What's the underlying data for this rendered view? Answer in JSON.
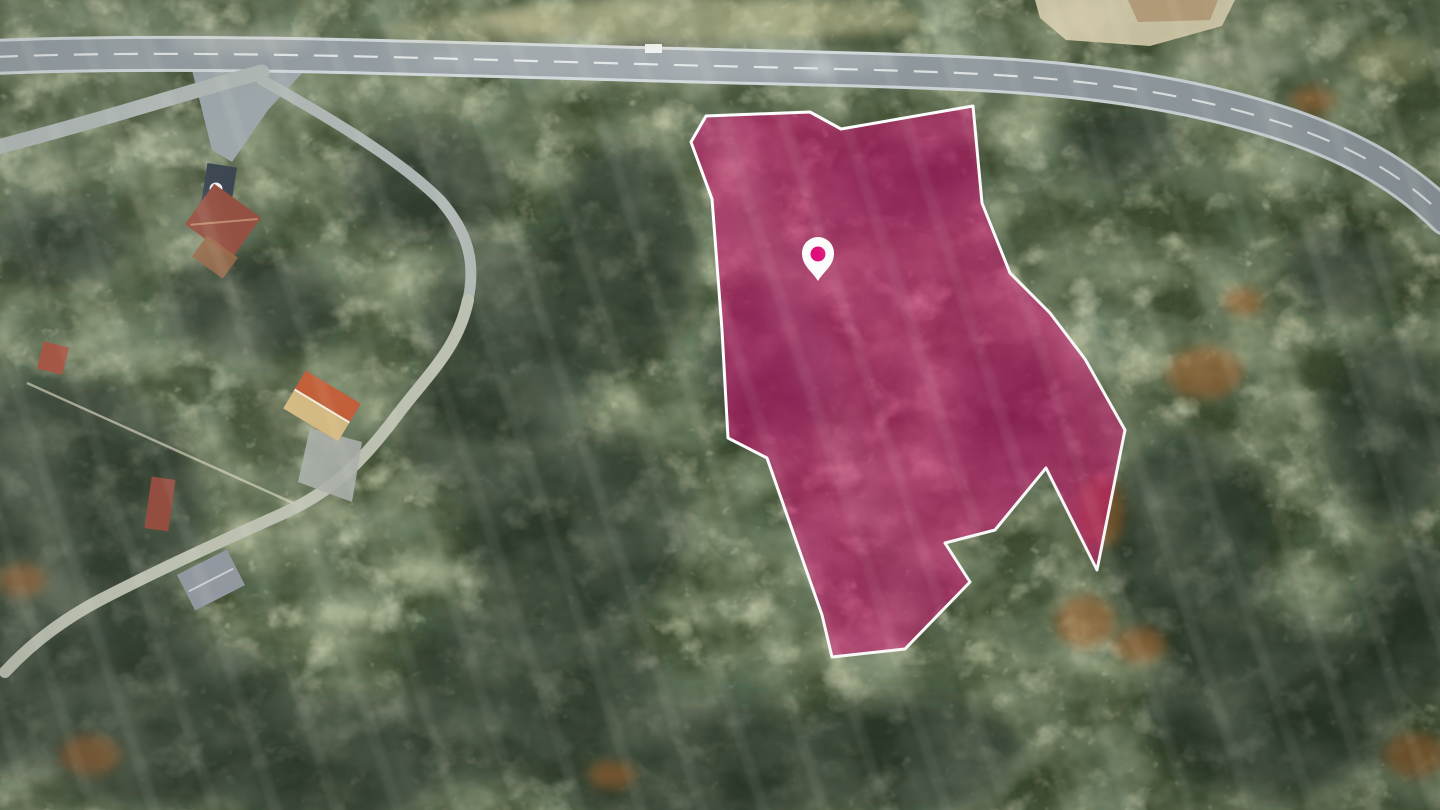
{
  "scene": {
    "title": "Aerial drone photograph of forested hillside with highlighted land parcel",
    "width": 1440,
    "height": 810
  },
  "palette": {
    "forest_base": "#3d4a2e",
    "forest_mid": "#68784c",
    "forest_light": "#b9bd84",
    "forest_pale": "#daddab",
    "shadow_color": "#15231c",
    "shadow_opacity": "0.52",
    "rust_color": "#a4612c",
    "rust_opacity": "0.55",
    "road_asphalt": "#8e989d",
    "road_casing": "#ccd3d6",
    "road_secondary": "#abb3b0",
    "road_dirt": "#b9beae",
    "lane_marking": "#f3f5f4",
    "junction_apron": "#98a2a6",
    "footpath": "#d8d4be",
    "sand": "#dbd2b0",
    "terrace": "#b69a74"
  },
  "parcel": {
    "points": "706,116 810,112 841,129 973,106 982,203 1010,273 1050,313 1085,359 1125,430 1097,570 1046,468 995,530 945,543 970,582 905,649 832,657 822,615 767,458 728,438 722,330 712,199 691,142",
    "fill": "#d80e74",
    "fill_opacity": "0.55",
    "stroke": "#ffffff",
    "stroke_width": "3"
  },
  "pin": {
    "d": "M 818 281 C 812 271 802 266 802 253 A 16 16 0 1 1 834 253 C 834 266 824 271 818 281 Z",
    "fill": "#ffffff",
    "dot_cx": "818",
    "dot_cy": "254",
    "dot_r": "7.5",
    "dot_fill": "#e00b78"
  },
  "roads": {
    "main_d": "M -6 57 C 180 49 420 58 640 64 C 780 68 880 69 980 74 C 1100 80 1200 96 1290 126 C 1360 150 1408 180 1446 218",
    "main_width": "30",
    "casing_width": "36",
    "dash_array": "24 16",
    "dash_width": "2.2",
    "dash_opacity": "0.8",
    "branch_left_d": "M 262 72 C 200 88 120 115 -6 148",
    "branch_left_width": "15",
    "east_d": "M 262 80 C 330 118 400 160 440 200 C 468 232 476 262 468 300",
    "east_width": "11",
    "west_d": "M 468 300 C 458 348 430 372 398 414 C 362 462 332 492 282 514 C 228 538 158 570 100 600 C 62 620 30 645 5 672",
    "west_width": "12",
    "footpath_d": "M 27 383 L 293 503",
    "footpath_width": "2.5",
    "footpath_opacity": "0.65",
    "junction_d": "M 192 70 L 305 70 L 268 110 L 232 162 L 212 150 Z",
    "clearing_d": "M 1035 0 L 1235 0 L 1222 26 L 1150 46 L 1066 40 L 1040 18 Z",
    "terrace_d": "M 1128 0 L 1218 0 L 1210 20 L 1138 22 Z"
  },
  "houses": [
    {
      "data-name": "driveway-pad",
      "d": "M 310 428 L 362 442 L 352 502 L 298 482 Z",
      "fill": "#a6aca6",
      "opacity": "0.9"
    },
    {
      "data-name": "navy-roof-house",
      "d": "M 203 165 h 30 v 55 h -30 Z",
      "transform": "rotate(9 218 192)",
      "fill": "#333e4a"
    },
    {
      "data-name": "roof-vent-circle",
      "d": "M 209.5 189 a 6.5 6.5 0 1 0 13 0 a 6.5 6.5 0 1 0 -13 0 Z",
      "fill": "#eef1f1"
    },
    {
      "data-name": "red-roof-house",
      "d": "M 194 196 h 58 v 50 h -58 Z",
      "transform": "rotate(36 223 221)",
      "fill": "#8f4839"
    },
    {
      "data-name": "red-roof-ridge",
      "d": "M 199 243 L 250 199",
      "transform": "rotate(36 223 221)",
      "fill": "none",
      "stroke": "#bd8468",
      "stroke-width": "2"
    },
    {
      "data-name": "wooden-deck",
      "d": "M 196 244 h 38 v 26 h -38 Z",
      "transform": "rotate(36 215 257)",
      "fill": "#95603e",
      "opacity": "0.85"
    },
    {
      "data-name": "small-red-roof",
      "d": "M 40 344 h 26 v 28 h -26 Z",
      "transform": "rotate(14 53 358)",
      "fill": "#a24e3b"
    },
    {
      "data-name": "orange-roof-house",
      "d": "M 290 384 h 64 v 44 h -64 Z",
      "transform": "rotate(31 322 406)",
      "fill": "#c05a33"
    },
    {
      "data-name": "orange-roof-light-face",
      "d": "M 290 406 h 64 v 22 h -64 Z",
      "transform": "rotate(31 322 406)",
      "fill": "#d2bd83",
      "opacity": "0.95"
    },
    {
      "data-name": "orange-roof-ridge",
      "d": "M 290 406 h 64",
      "transform": "rotate(31 322 406)",
      "fill": "none",
      "stroke": "#f2ecdc",
      "stroke-width": "2"
    },
    {
      "data-name": "red-cabin-roof",
      "d": "M 148 478 h 24 v 52 h -24 Z",
      "transform": "rotate(8 160 504)",
      "fill": "#8e4638"
    },
    {
      "data-name": "gray-roof-house",
      "d": "M 183 560 h 56 v 40 h -56 Z",
      "transform": "rotate(-27 211 580)",
      "fill": "#8e949b"
    },
    {
      "data-name": "gray-roof-ridge",
      "d": "M 186 580 h 50",
      "transform": "rotate(-27 211 580)",
      "fill": "none",
      "stroke": "#c6cbd1",
      "stroke-width": "2"
    },
    {
      "data-name": "white-car",
      "d": "M 645 44 h 17 v 9 h -17 Z",
      "fill": "#edf0ef"
    }
  ],
  "forest": {
    "shadows": [
      {
        "cx": 55,
        "cy": 505,
        "rx": 150,
        "ry": 130
      },
      {
        "cx": 45,
        "cy": 665,
        "rx": 170,
        "ry": 110
      },
      {
        "cx": 175,
        "cy": 725,
        "rx": 140,
        "ry": 85
      },
      {
        "cx": 330,
        "cy": 760,
        "rx": 120,
        "ry": 70
      },
      {
        "cx": 530,
        "cy": 690,
        "rx": 130,
        "ry": 95
      },
      {
        "cx": 700,
        "cy": 765,
        "rx": 150,
        "ry": 70
      },
      {
        "cx": 905,
        "cy": 755,
        "rx": 120,
        "ry": 60
      },
      {
        "cx": 425,
        "cy": 185,
        "rx": 85,
        "ry": 60
      },
      {
        "cx": 520,
        "cy": 330,
        "rx": 100,
        "ry": 90
      },
      {
        "cx": 575,
        "cy": 525,
        "rx": 115,
        "ry": 100
      },
      {
        "cx": 625,
        "cy": 255,
        "rx": 70,
        "ry": 115
      },
      {
        "cx": 480,
        "cy": 430,
        "rx": 80,
        "ry": 70
      },
      {
        "cx": 1190,
        "cy": 545,
        "rx": 85,
        "ry": 110
      },
      {
        "cx": 1275,
        "cy": 705,
        "rx": 130,
        "ry": 90
      },
      {
        "cx": 1390,
        "cy": 430,
        "rx": 65,
        "ry": 95
      },
      {
        "cx": 1420,
        "cy": 620,
        "rx": 60,
        "ry": 80
      },
      {
        "cx": 250,
        "cy": 305,
        "rx": 90,
        "ry": 55
      },
      {
        "cx": 770,
        "cy": 365,
        "rx": 65,
        "ry": 85
      },
      {
        "cx": 905,
        "cy": 185,
        "rx": 75,
        "ry": 45
      },
      {
        "cx": 1005,
        "cy": 425,
        "rx": 55,
        "ry": 65
      },
      {
        "cx": 60,
        "cy": 240,
        "rx": 70,
        "ry": 45
      },
      {
        "cx": 1340,
        "cy": 270,
        "rx": 55,
        "ry": 45
      },
      {
        "cx": 1120,
        "cy": 145,
        "rx": 60,
        "ry": 40
      }
    ],
    "rusts": [
      {
        "cx": 1205,
        "cy": 373,
        "rx": 38,
        "ry": 26
      },
      {
        "cx": 1100,
        "cy": 512,
        "rx": 24,
        "ry": 36
      },
      {
        "cx": 1085,
        "cy": 622,
        "rx": 30,
        "ry": 26
      },
      {
        "cx": 1140,
        "cy": 645,
        "rx": 26,
        "ry": 18
      },
      {
        "cx": 90,
        "cy": 755,
        "rx": 30,
        "ry": 20
      },
      {
        "cx": 22,
        "cy": 580,
        "rx": 24,
        "ry": 16
      },
      {
        "cx": 1312,
        "cy": 100,
        "rx": 22,
        "ry": 14
      },
      {
        "cx": 1243,
        "cy": 302,
        "rx": 20,
        "ry": 14
      },
      {
        "cx": 1415,
        "cy": 755,
        "rx": 30,
        "ry": 22
      },
      {
        "cx": 612,
        "cy": 775,
        "rx": 24,
        "ry": 14
      }
    ],
    "brights": [
      {
        "cx": 660,
        "cy": 60,
        "rx": 240,
        "ry": 24,
        "fill": "#ffffff",
        "opacity": "0.15"
      },
      {
        "cx": 700,
        "cy": 20,
        "rx": 220,
        "ry": 22,
        "fill": "#d6d0a2",
        "opacity": "0.5"
      },
      {
        "cx": 480,
        "cy": 28,
        "rx": 90,
        "ry": 16,
        "fill": "#cfc89e",
        "opacity": "0.35"
      },
      {
        "cx": 819,
        "cy": 69,
        "rx": 14,
        "ry": 9,
        "fill": "#dfe5e7",
        "opacity": "0.45"
      },
      {
        "cx": 1240,
        "cy": 62,
        "rx": 60,
        "ry": 16,
        "fill": "#e8e3cf",
        "opacity": "0.3"
      },
      {
        "cx": 240,
        "cy": 40,
        "rx": 70,
        "ry": 14,
        "fill": "#e2e0d2",
        "opacity": "0.25"
      },
      {
        "cx": 1395,
        "cy": 58,
        "rx": 40,
        "ry": 26,
        "fill": "#d9d79a",
        "opacity": "0.3"
      }
    ]
  }
}
